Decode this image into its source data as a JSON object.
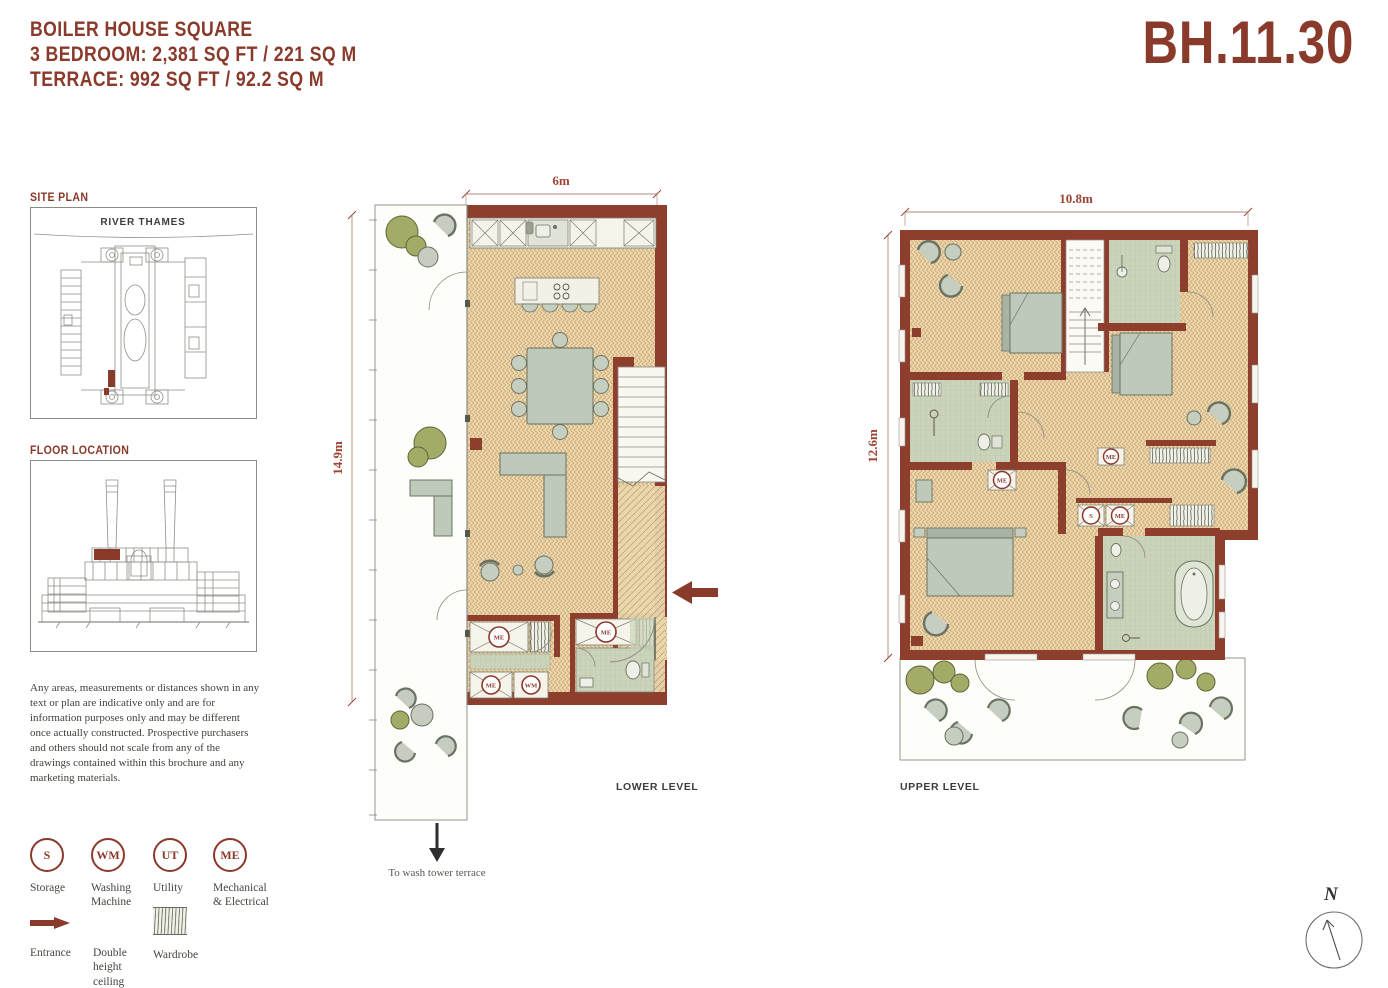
{
  "header": {
    "project_name": "BOILER HOUSE SQUARE",
    "spec_line": "3 BEDROOM: 2,381 SQ FT / 221 SQ M",
    "terrace_line": "TERRACE: 992 SQ FT / 92.2 SQ M",
    "unit_code": "BH.11.30"
  },
  "site_plan": {
    "title": "SITE PLAN",
    "river_label": "RIVER THAMES"
  },
  "floor_location": {
    "title": "FLOOR LOCATION"
  },
  "disclaimer": "Any areas, measurements or distances shown in any text or plan are indicative only and are for information purposes only and may be different once actually constructed. Prospective purchasers and others should not scale from any of the drawings contained within this brochure and any marketing materials.",
  "legend": {
    "items": [
      {
        "abbr": "S",
        "label": "Storage"
      },
      {
        "abbr": "WM",
        "label": "Washing\nMachine"
      },
      {
        "abbr": "UT",
        "label": "Utility"
      },
      {
        "abbr": "ME",
        "label": "Mechanical\n& Electrical"
      }
    ],
    "symbols": [
      {
        "icon": "entrance-arrow",
        "label": "Entrance"
      },
      {
        "icon": "double-height-ceiling",
        "label": "Double\nheight\nceiling"
      },
      {
        "icon": "wardrobe-hatch",
        "label": "Wardrobe"
      }
    ]
  },
  "lower_level": {
    "caption": "LOWER LEVEL",
    "width_dimension": "6m",
    "height_dimension": "14.9m",
    "terrace_note": "To wash tower terrace"
  },
  "upper_level": {
    "caption": "UPPER LEVEL",
    "width_dimension": "10.8m",
    "height_dimension": "12.6m"
  },
  "compass": {
    "label": "N"
  },
  "colors": {
    "accent_red": "#8a3a2b",
    "wall_red": "#8e3e2d",
    "floor_tan": "#ecd9b0",
    "floor_stroke": "#c9a26b",
    "tile_green": "#cbd4ba",
    "furniture_sage": "#bfc9b9",
    "bush_olive": "#a3ab66",
    "dimension_red": "#9c4434",
    "caption_gray": "#3d3d3d"
  }
}
